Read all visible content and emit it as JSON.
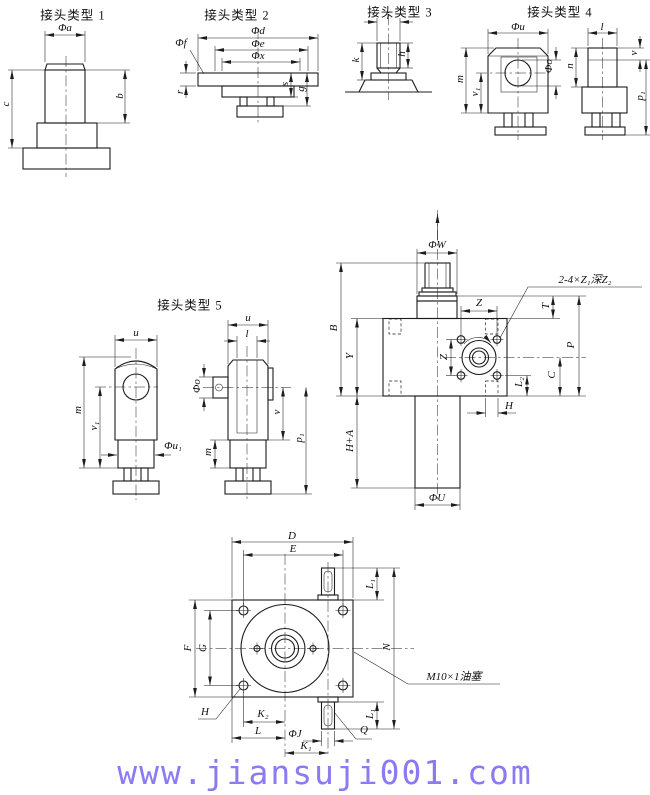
{
  "page": {
    "background": "#ffffff",
    "line_color": "#1c1c1c"
  },
  "titles": {
    "type1": "接头类型 1",
    "type2": "接头类型 2",
    "type3": "接头类型 3",
    "type4": "接头类型 4",
    "type5": "接头类型 5"
  },
  "type1": {
    "dia_a": "Φa",
    "b": "b",
    "c": "c"
  },
  "type2": {
    "dia_d": "Φd",
    "dia_e": "Φe",
    "dia_x": "Φx",
    "dia_f": "Φf",
    "r": "r",
    "s": "s",
    "g": "g"
  },
  "type3": {
    "i": "i",
    "k": "k",
    "h": "h"
  },
  "type4": {
    "dia_u": "Φu",
    "m": "m",
    "v1": "v₁",
    "dia_o": "Φo",
    "l": "l",
    "n": "n",
    "v": "v",
    "p1": "p₁"
  },
  "type5": {
    "u_left": "u",
    "m_left": "m",
    "v1": "v₁",
    "dia_u1": "Φu₁",
    "u_right": "u",
    "l": "l",
    "dia_o": "Φo",
    "v": "v",
    "p1": "p₁",
    "m_right": "m"
  },
  "assembly": {
    "dia_w": "ΦW",
    "tap_callout": "2-4×Z₁深Z₂",
    "z_horizontal": "Z",
    "z_vertical": "Z",
    "t": "T",
    "p": "P",
    "c": "C",
    "l2": "L₂",
    "h": "H",
    "b": "B",
    "y": "Y",
    "h_plus_a": "H+A",
    "dia_u": "ΦU"
  },
  "bottom_view": {
    "d": "D",
    "e": "E",
    "l1_top": "L₁",
    "n": "N",
    "oil_plug": "M10×1油塞",
    "f": "F",
    "g": "G",
    "h": "H",
    "k2": "K₂",
    "l": "L",
    "dia_j": "ΦJ",
    "k1": "K₁",
    "l1_bottom": "L₁",
    "q": "Q"
  },
  "watermark": {
    "text": "www.jiansuji001.com",
    "color": "#8b7af2"
  }
}
